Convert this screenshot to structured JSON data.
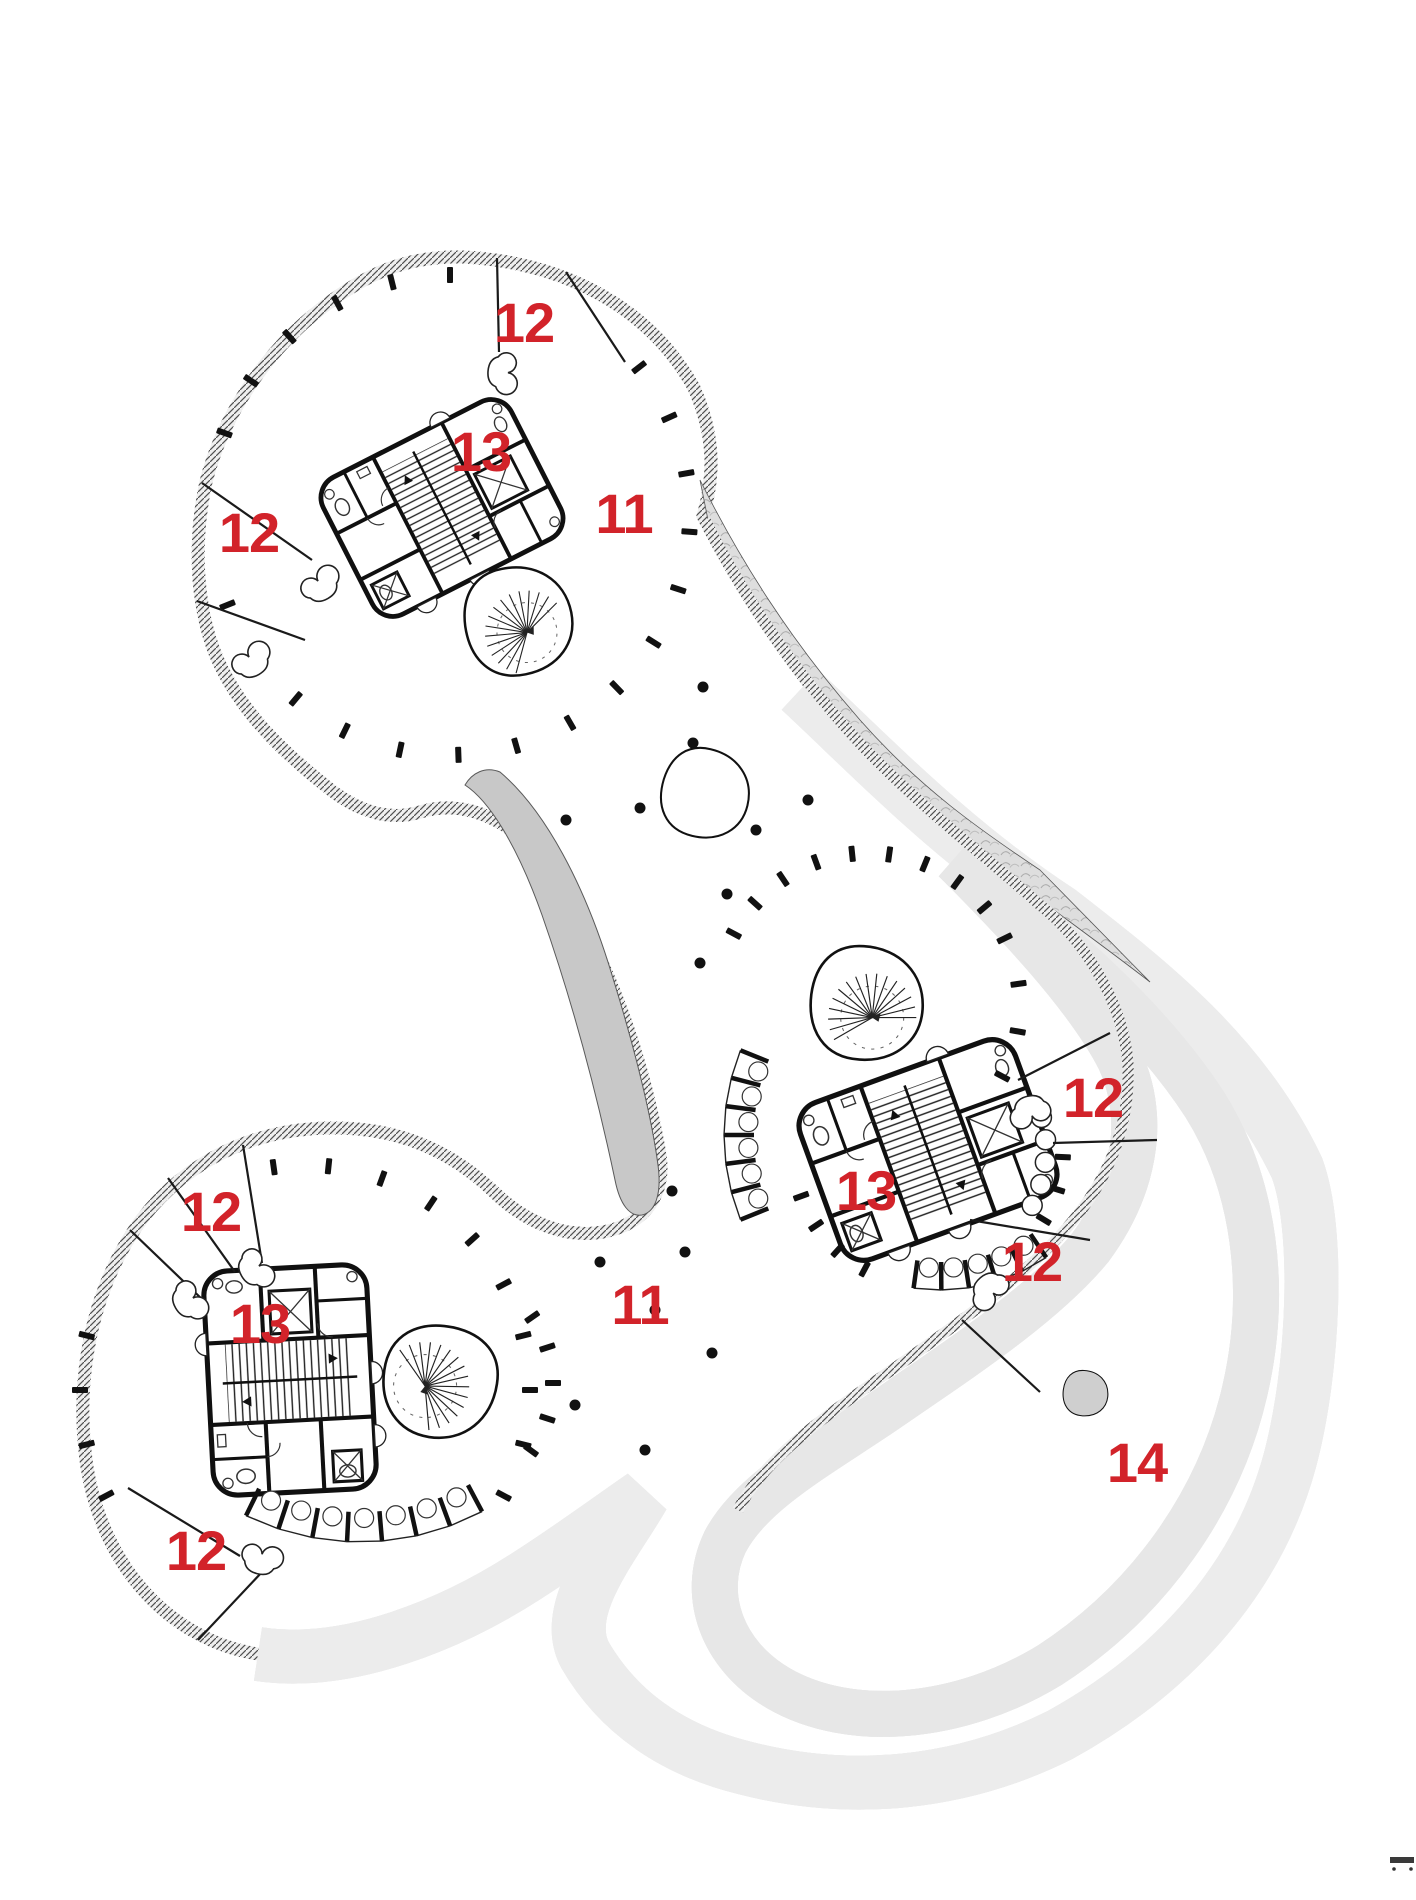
{
  "plan": {
    "label_color": "#d2232a",
    "labels": [
      {
        "name": "terrace-north",
        "value": "12"
      },
      {
        "name": "terrace-northwest",
        "value": "12"
      },
      {
        "name": "core-north",
        "value": "13"
      },
      {
        "name": "floor-area-north",
        "value": "11"
      },
      {
        "name": "terrace-east",
        "value": "12"
      },
      {
        "name": "core-central",
        "value": "13"
      },
      {
        "name": "terrace-southeast",
        "value": "12"
      },
      {
        "name": "terrace-west",
        "value": "12"
      },
      {
        "name": "core-southwest",
        "value": "13"
      },
      {
        "name": "floor-area-south",
        "value": "11"
      },
      {
        "name": "terrace-south",
        "value": "12"
      },
      {
        "name": "roof-garden",
        "value": "14"
      }
    ]
  }
}
